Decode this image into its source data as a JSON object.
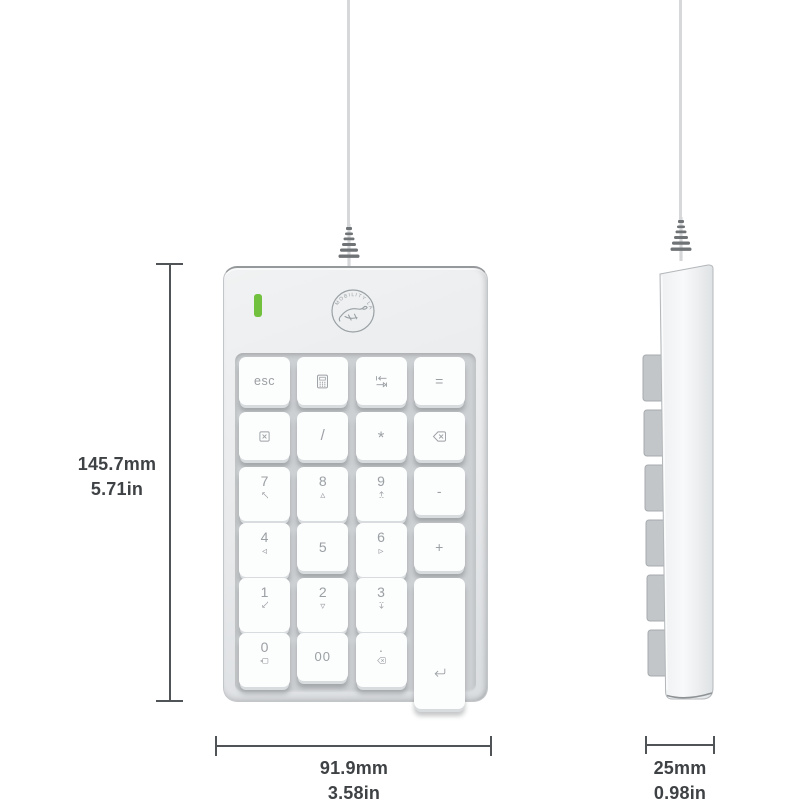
{
  "device": {
    "brand": "MOBILITY LAB",
    "led_color": "#72c13e",
    "views": [
      "front",
      "side"
    ],
    "keys": [
      {
        "name": "key-esc",
        "label": "esc",
        "row": 0,
        "col": 0
      },
      {
        "name": "key-calculator",
        "icon": "calculator-icon",
        "row": 0,
        "col": 1
      },
      {
        "name": "key-tab",
        "icon": "tab-icon",
        "row": 0,
        "col": 2
      },
      {
        "name": "key-equals",
        "label": "=",
        "row": 0,
        "col": 3
      },
      {
        "name": "key-numlock",
        "icon": "numlock-icon",
        "row": 1,
        "col": 0
      },
      {
        "name": "key-divide",
        "label": "/",
        "row": 1,
        "col": 1
      },
      {
        "name": "key-multiply",
        "label": "*",
        "row": 1,
        "col": 2
      },
      {
        "name": "key-backspace",
        "icon": "backspace-icon",
        "row": 1,
        "col": 3
      },
      {
        "name": "key-7",
        "label": "7",
        "subicon": "home-icon",
        "row": 2,
        "col": 0
      },
      {
        "name": "key-8",
        "label": "8",
        "sub": "▵",
        "row": 2,
        "col": 1
      },
      {
        "name": "key-9",
        "label": "9",
        "subicon": "page-up-icon",
        "row": 2,
        "col": 2
      },
      {
        "name": "key-minus",
        "label": "-",
        "row": 2,
        "col": 3
      },
      {
        "name": "key-4",
        "label": "4",
        "sub": "◃",
        "row": 3,
        "col": 0
      },
      {
        "name": "key-5",
        "label": "5",
        "row": 3,
        "col": 1
      },
      {
        "name": "key-6",
        "label": "6",
        "sub": "▹",
        "row": 3,
        "col": 2
      },
      {
        "name": "key-plus",
        "label": "+",
        "row": 3,
        "col": 3
      },
      {
        "name": "key-1",
        "label": "1",
        "subicon": "end-icon",
        "row": 4,
        "col": 0
      },
      {
        "name": "key-2",
        "label": "2",
        "sub": "▿",
        "row": 4,
        "col": 1
      },
      {
        "name": "key-3",
        "label": "3",
        "subicon": "page-down-icon",
        "row": 4,
        "col": 2
      },
      {
        "name": "key-enter",
        "icon": "enter-icon",
        "row": 4,
        "col": 3,
        "rowspan": 2
      },
      {
        "name": "key-0",
        "label": "0",
        "subicon": "insert-icon",
        "row": 5,
        "col": 0
      },
      {
        "name": "key-00",
        "label": "00",
        "row": 5,
        "col": 1
      },
      {
        "name": "key-decimal",
        "label": ".",
        "subicon": "delete-icon",
        "row": 5,
        "col": 2
      }
    ]
  },
  "annotations": {
    "height": {
      "mm": "145.7mm",
      "inch": "5.71in"
    },
    "width": {
      "mm": "91.9mm",
      "inch": "3.58in"
    },
    "depth": {
      "mm": "25mm",
      "inch": "0.98in"
    }
  }
}
